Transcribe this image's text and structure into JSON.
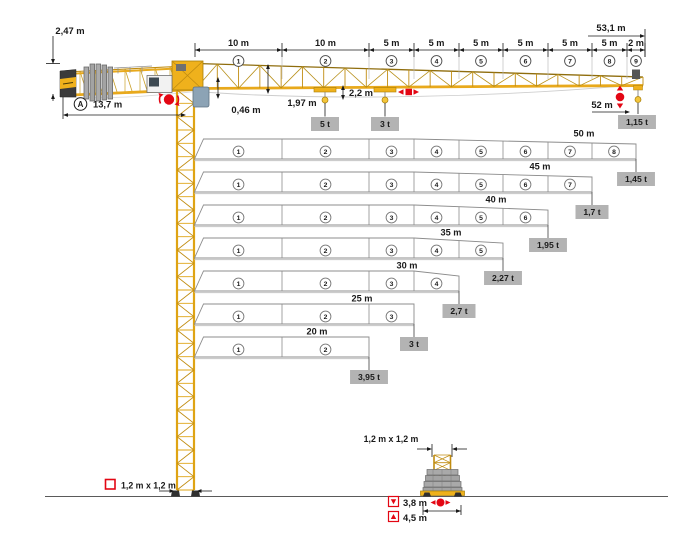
{
  "labels": {
    "counter_jib_height": "2,47 m",
    "counter_jib_ref": "A",
    "counter_jib_radius": "13,7 m",
    "total_jib_length": "53,1 m",
    "jib_foot_offset": "0,46 m",
    "jib_root_height": "1,97 m",
    "trolley_drop_height": "2,2 m",
    "trolley1_capacity": "5 t",
    "trolley2_capacity": "3 t",
    "max_hook_radius": "52 m",
    "tip_capacity": "1,15 t",
    "mast_cross_section": "1,2 m x 1,2 m",
    "mast_cross_section_base": "1,2 m x 1,2 m",
    "base_width_inner": "3,8 m",
    "base_width_outer": "4,5 m"
  },
  "jib_sections": [
    {
      "num": "1",
      "length": "10 m"
    },
    {
      "num": "2",
      "length": "10 m"
    },
    {
      "num": "3",
      "length": "5 m"
    },
    {
      "num": "4",
      "length": "5 m"
    },
    {
      "num": "5",
      "length": "5 m"
    },
    {
      "num": "6",
      "length": "5 m"
    },
    {
      "num": "7",
      "length": "5 m"
    },
    {
      "num": "8",
      "length": "5 m"
    },
    {
      "num": "9",
      "length": "2 m"
    }
  ],
  "configurations": [
    {
      "jib_length": "50 m",
      "sections": [
        "1",
        "2",
        "3",
        "4",
        "5",
        "6",
        "7",
        "8"
      ],
      "tip_load": "1,45 t"
    },
    {
      "jib_length": "45 m",
      "sections": [
        "1",
        "2",
        "3",
        "4",
        "5",
        "6",
        "7"
      ],
      "tip_load": "1,7 t"
    },
    {
      "jib_length": "40 m",
      "sections": [
        "1",
        "2",
        "3",
        "4",
        "5",
        "6"
      ],
      "tip_load": "1,95 t"
    },
    {
      "jib_length": "35 m",
      "sections": [
        "1",
        "2",
        "3",
        "4",
        "5"
      ],
      "tip_load": "2,27 t"
    },
    {
      "jib_length": "30 m",
      "sections": [
        "1",
        "2",
        "3",
        "4"
      ],
      "tip_load": "2,7 t"
    },
    {
      "jib_length": "25 m",
      "sections": [
        "1",
        "2",
        "3"
      ],
      "tip_load": "3 t"
    },
    {
      "jib_length": "20 m",
      "sections": [
        "1",
        "2"
      ],
      "tip_load": "3,95 t"
    }
  ],
  "colors": {
    "crane_yellow": "#EFB11C",
    "chord_yellow": "#DFA414",
    "lattice_dark": "#A87F08",
    "label_box": "#B3B3B3",
    "red": "#E30613",
    "ink": "#1A1A1A",
    "structure_gray": "#A9A9A9"
  }
}
